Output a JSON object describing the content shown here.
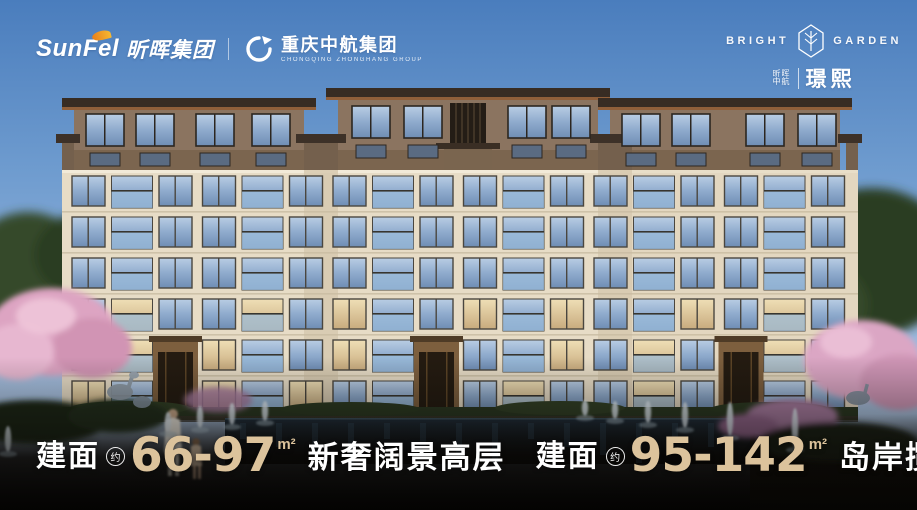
{
  "brand_bar": {
    "sunfel": {
      "latin": "SunFel",
      "cn": "昕晖集团"
    },
    "zhonghang": {
      "cn": "重庆中航集团",
      "en": "CHONGQING ZHONGHANG GROUP"
    },
    "project": {
      "en_left": "BRIGHT",
      "en_right": "GARDEN",
      "owner_line1": "昕晖",
      "owner_line2": "中航",
      "name": "璟熙"
    }
  },
  "tagline": {
    "segments": [
      {
        "label": "建面",
        "approx": "约",
        "range": "66-97",
        "unit": "m²",
        "desc": "新奢阔景高层"
      },
      {
        "label": "建面",
        "approx": "约",
        "range": "95-142",
        "unit": "m²",
        "desc": "岛岸揽景洋房"
      }
    ]
  },
  "scene_colors": {
    "sky_top": "#4a7dbd",
    "sky_bottom": "#c3d5ea",
    "facade_cream": "#e7dcc6",
    "penthouse_brown": "#8b7460",
    "roof_dark": "#372c23",
    "roof_fascia": "#8f5f3a",
    "window_glass": "#9db6d4",
    "warm_glass": "#e8d4a8",
    "pool_water": "#16222b",
    "blossom_pink": "#dda4c2",
    "foliage_green": "#35482b",
    "accent_gold": "#dcc39c",
    "text_white": "#ffffff"
  }
}
